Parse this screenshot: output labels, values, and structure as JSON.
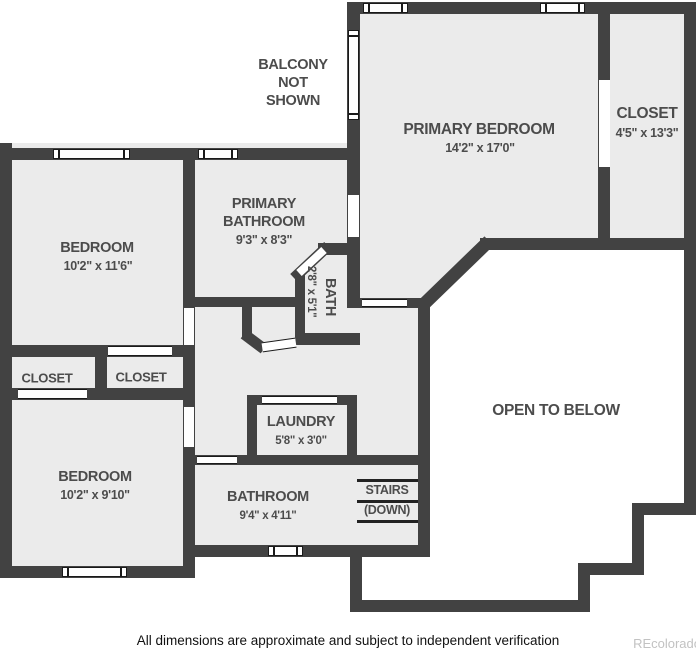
{
  "page": {
    "disclaimer": "All dimensions are approximate and subject to independent verification",
    "watermark": "REcolorado"
  },
  "annotations": {
    "balcony": "BALCONY NOT SHOWN",
    "open_to_below": "OPEN TO BELOW"
  },
  "rooms": {
    "primary_bedroom": {
      "name": "PRIMARY BEDROOM",
      "dims": "14'2\" x 17'0\""
    },
    "primary_closet": {
      "name": "CLOSET",
      "dims": "4'5\" x 13'3\""
    },
    "primary_bathroom": {
      "name": "PRIMARY BATHROOM",
      "dims": "9'3\" x 8'3\""
    },
    "bath": {
      "name": "BATH",
      "dims": "2'8\" x 5'1\""
    },
    "bedroom_upper": {
      "name": "BEDROOM",
      "dims": "10'2\" x 11'6\""
    },
    "closet_left": {
      "name": "CLOSET"
    },
    "closet_right": {
      "name": "CLOSET"
    },
    "bedroom_lower": {
      "name": "BEDROOM",
      "dims": "10'2\" x 9'10\""
    },
    "laundry": {
      "name": "LAUNDRY",
      "dims": "5'8\" x 3'0\""
    },
    "bathroom": {
      "name": "BATHROOM",
      "dims": "9'4\" x 4'11\""
    },
    "stairs": {
      "name": "STAIRS",
      "direction": "(DOWN)"
    }
  }
}
